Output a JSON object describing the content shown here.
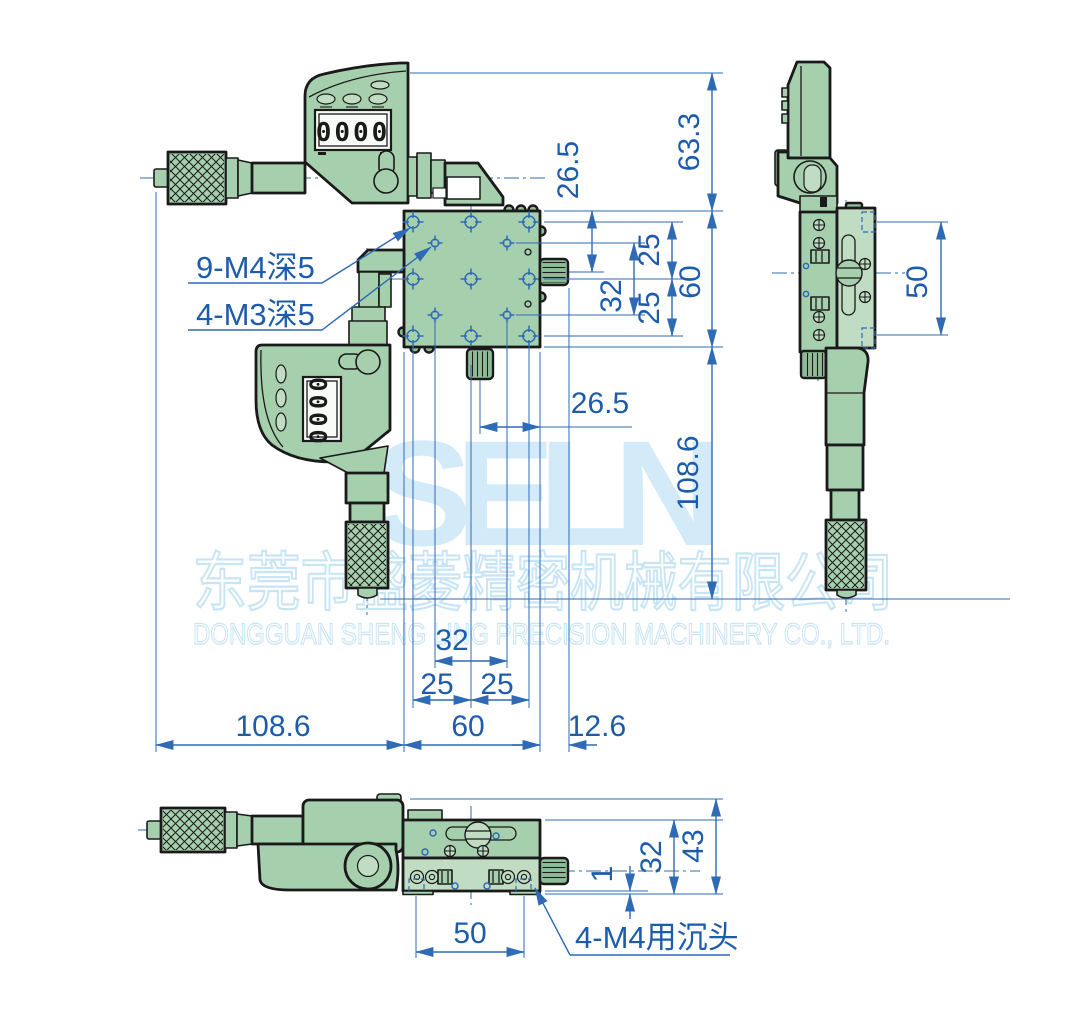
{
  "drawing_type": "mechanical-dimension-drawing",
  "subject": "XY precision stage with two digital micrometer heads, three orthographic views",
  "watermark": {
    "brand": "SELN",
    "company_cn": "东莞市盛菱精密机械有限公司",
    "company_en": "DONGGUAN SHENG LING PRECISION MACHINERY CO., LTD."
  },
  "lcd": {
    "digits": "0000"
  },
  "callouts": {
    "m4_tapped_holes": "9-M4深5",
    "m3_tapped_holes": "4-M3深5",
    "m4_counterbore": "4-M4用沉头"
  },
  "dimensions": {
    "top_view": {
      "display_to_stage_top": "63.3",
      "stage_top_to_x_knob_center": "26.5",
      "hole_row_pitch_upper": "25",
      "hole_row_pitch_lower": "25",
      "m3_hole_row_span": "32",
      "stage_height": "60",
      "stage_bottom_to_mic_tip": "108.6",
      "y_knob_center_to_stage_right": "26.5",
      "m3_hole_col_span": "32",
      "hole_col_pitch_left": "25",
      "hole_col_pitch_right": "25",
      "mic_tip_to_stage_left": "108.6",
      "stage_width": "60",
      "stage_right_to_knob_tip": "12.6"
    },
    "side_view": {
      "counterbore_hole_pitch": "50"
    },
    "front_view": {
      "counterbore_hole_pitch": "50",
      "base_lip": "1",
      "platform_height": "32",
      "total_height": "43"
    }
  },
  "colors": {
    "body_green": "#a6d0ad",
    "body_green_light": "#c0ddc3",
    "body_green_dark": "#8fbc98",
    "ink": "#1a1a1a",
    "dim_blue": "#2f6ab5",
    "dim_text": "#1d5cab",
    "watermark_fill": "#d3eaf8",
    "watermark_stroke": "#c8e5f6",
    "lcd_bg": "#f8fbf8"
  }
}
